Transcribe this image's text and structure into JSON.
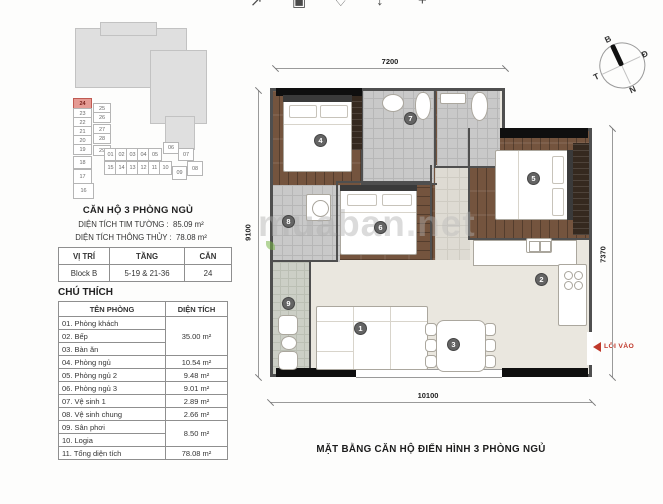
{
  "toolbar": {
    "icons": [
      {
        "name": "share-icon",
        "glyph": "↗"
      },
      {
        "name": "save-icon",
        "glyph": "▣"
      },
      {
        "name": "heart-icon",
        "glyph": "♡"
      },
      {
        "name": "download-icon",
        "glyph": "↓"
      },
      {
        "name": "plus-icon",
        "glyph": "+"
      }
    ]
  },
  "key_plan": {
    "highlighted_unit": "24",
    "col1": [
      "24",
      "23",
      "22",
      "21",
      "20",
      "19",
      "18",
      "17",
      "16"
    ],
    "col2": [
      "25",
      "26",
      "27",
      "28",
      "29"
    ],
    "row1": [
      "01",
      "02",
      "03",
      "04",
      "05",
      "06",
      "07"
    ],
    "row2": [
      "15",
      "14",
      "13",
      "12",
      "11",
      "10",
      "09",
      "08"
    ]
  },
  "unit_info": {
    "title": "CĂN HỘ 3 PHÒNG NGỦ",
    "line1_label": "DIỆN TÍCH TIM TƯỜNG :",
    "line1_value": "85.09 m²",
    "line2_label": "DIỆN TÍCH THÔNG THỦY :",
    "line2_value": "78.08 m²"
  },
  "position_table": {
    "headers": [
      "VỊ TRÍ",
      "TẦNG",
      "CĂN"
    ],
    "row": [
      "Block B",
      "5-19 & 21-36",
      "24"
    ]
  },
  "legend": {
    "title": "CHÚ THÍCH",
    "col_room": "TÊN PHÒNG",
    "col_area": "DIỆN TÍCH",
    "rows": [
      {
        "name": "01. Phòng khách",
        "area": "35.00 m²"
      },
      {
        "name": "02. Bếp"
      },
      {
        "name": "03. Bàn ăn"
      },
      {
        "name": "04. Phòng ngủ",
        "area": "10.54 m²"
      },
      {
        "name": "05. Phòng ngủ 2",
        "area": "9.48 m²"
      },
      {
        "name": "06. Phòng ngủ 3",
        "area": "9.01 m²"
      },
      {
        "name": "07. Vệ sinh 1",
        "area": "2.89 m²"
      },
      {
        "name": "08. Vệ sinh chung",
        "area": "2.66 m²"
      },
      {
        "name": "09. Sân phơi",
        "area": "8.50 m²"
      },
      {
        "name": "10. Logia"
      },
      {
        "name": "11. Tổng diện tích",
        "area": "78.08 m²"
      }
    ]
  },
  "floor_plan": {
    "dimensions": {
      "top": "7200",
      "left": "9100",
      "right": "7370",
      "bottom": "10100"
    },
    "markers": [
      "1",
      "2",
      "3",
      "4",
      "5",
      "6",
      "7",
      "8",
      "9"
    ],
    "entry_label": "LỐI VÀO"
  },
  "watermark": {
    "part1": "muaban",
    "part2": ".net"
  },
  "compass": {
    "north": "B",
    "east": "Đ",
    "west": "T",
    "south": "N"
  },
  "caption": "MẶT BẰNG CĂN HỘ ĐIỂN HÌNH 3 PHÒNG NGỦ",
  "colors": {
    "accent_red": "#c0392b",
    "highlight_unit": "#e59b94",
    "wood": "#74543e",
    "marker_gray": "#646464",
    "watermark_green": "#7ab648"
  }
}
